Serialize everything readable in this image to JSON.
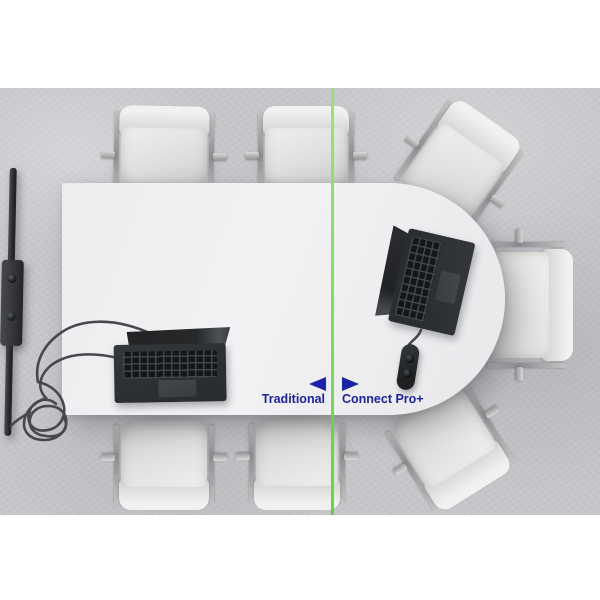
{
  "overlay": {
    "left_label": "Traditional",
    "right_label": "Connect Pro+",
    "label_color": "#1b23a8",
    "divider_color_top": "#8ce96b",
    "divider_color_bottom": "#55d62e"
  },
  "scene": {
    "setting": "top-down conference room with white racetrack table on concrete floor",
    "chairs_count": 7,
    "laptops_count": 2,
    "left_side_objects": [
      "edge-on-display",
      "mounted-speaker-camera",
      "tangled-cables",
      "laptop-with-cables"
    ],
    "right_side_objects": [
      "laptop",
      "connect-pro-hub-single-cable"
    ]
  }
}
